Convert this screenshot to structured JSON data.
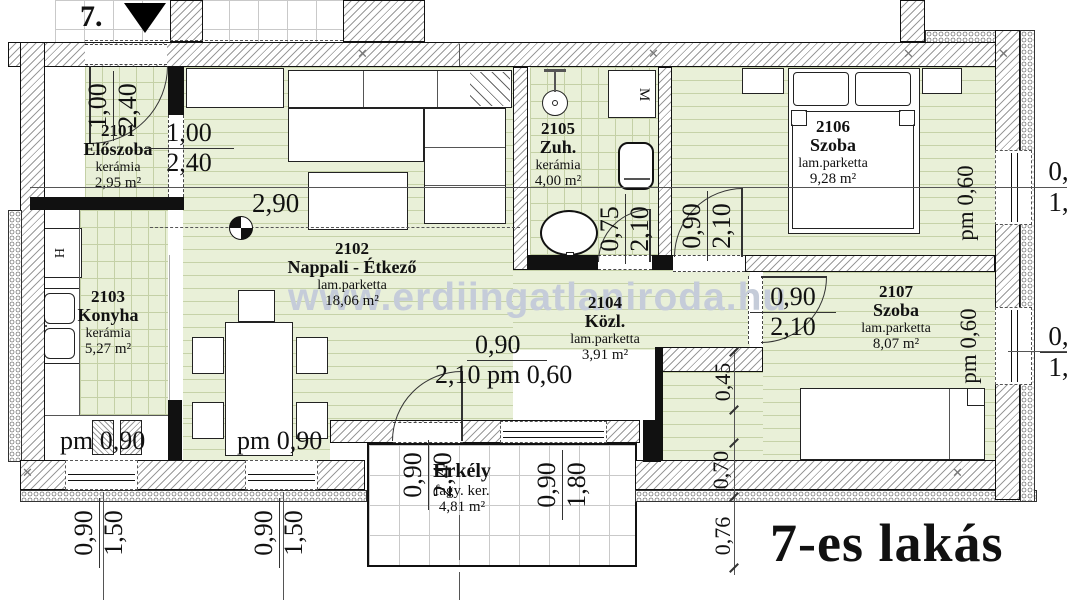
{
  "plan_title": "7-es lakás",
  "stair_label": "7.",
  "stair_arrow": "▼",
  "watermark": "www.erdiingatlaniroda.hu",
  "junction_mark": "✕",
  "appliances": {
    "fridge": "H",
    "washing_machine": "M"
  },
  "colors": {
    "room_fill": "#e9f0d8",
    "watermark": "#c5ccd9",
    "wall_outline": "#111111"
  },
  "rooms": [
    {
      "id": "2101",
      "name": "Előszoba",
      "floor": "kerámia",
      "area": "2,95 m²"
    },
    {
      "id": "2102",
      "name": "Nappali - Étkező",
      "floor": "lam.parketta",
      "area": "18,06 m²"
    },
    {
      "id": "2103",
      "name": "Konyha",
      "floor": "kerámia",
      "area": "5,27 m²"
    },
    {
      "id": "2104",
      "name": "Közl.",
      "floor": "lam.parketta",
      "area": "3,91 m²"
    },
    {
      "id": "2105",
      "name": "Zuh.",
      "floor": "kerámia",
      "area": "4,00 m²"
    },
    {
      "id": "2106",
      "name": "Szoba",
      "floor": "lam.parketta",
      "area": "9,28 m²"
    },
    {
      "id": "2107",
      "name": "Szoba",
      "floor": "lam.parketta",
      "area": "8,07 m²"
    },
    {
      "id": "",
      "name": "Erkély",
      "floor": "fagy. ker.",
      "area": "4,81 m²"
    }
  ],
  "dims": {
    "entry_door": {
      "a": "1,00",
      "b": "2,40"
    },
    "hall_opening": {
      "a": "1,00",
      "b": "2,40"
    },
    "living_width": "2,90",
    "bath_door": {
      "a": "0,75",
      "b": "2,10"
    },
    "room6_door": {
      "a": "0,90",
      "b": "2,10"
    },
    "room7_door": {
      "a": "0,90",
      "b": "2,10"
    },
    "balcony_door": {
      "a": "0,90",
      "b": "2,10",
      "parapet": "pm 0,60"
    },
    "kitchen_parapet": "pm 0,90",
    "dining_parapet": "pm 0,90",
    "win_room6_parapet": "pm 0,60",
    "win_room7_parapet": "pm 0,60",
    "right_window_top": {
      "a": "0,90",
      "b": "1,80"
    },
    "right_window_bottom": {
      "a": "0,90",
      "b": "1,80"
    },
    "balcony_left": {
      "a": "0,90",
      "b": "2,40"
    },
    "balcony_right": {
      "a": "0,90",
      "b": "1,80"
    },
    "window_sw1": {
      "a": "0,90",
      "b": "1,50"
    },
    "window_sw2": {
      "a": "0,90",
      "b": "1,50"
    },
    "side_chain": {
      "a": "0,45",
      "b": "0,70",
      "c": "0,76"
    }
  }
}
